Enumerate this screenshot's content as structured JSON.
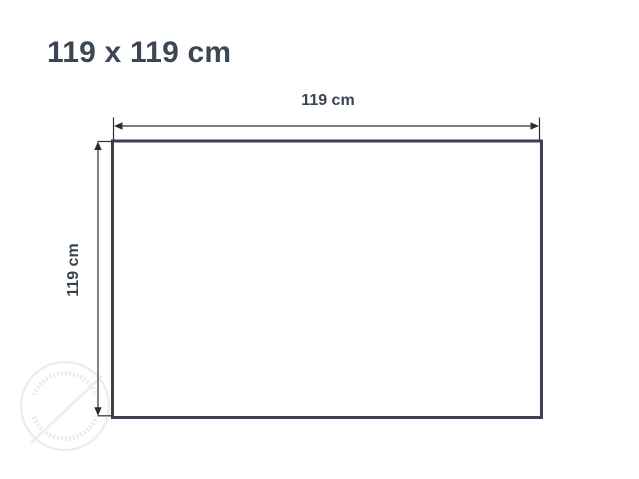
{
  "page": {
    "background_color": "#ffffff"
  },
  "title": {
    "text": "119 x 119 cm",
    "color": "#3d4753"
  },
  "diagram": {
    "width_label": "119 cm",
    "height_label": "119 cm",
    "frame": {
      "width_cm": 119,
      "height_cm": 119,
      "unit": "cm",
      "border_color": "#39424e",
      "fill_color": "#ffffff"
    },
    "dimensions": {
      "line_color": "#2b2f33",
      "label_color": "#3a4450"
    },
    "watermark": {
      "type": "circular-stamp",
      "color": "#ececec"
    }
  }
}
